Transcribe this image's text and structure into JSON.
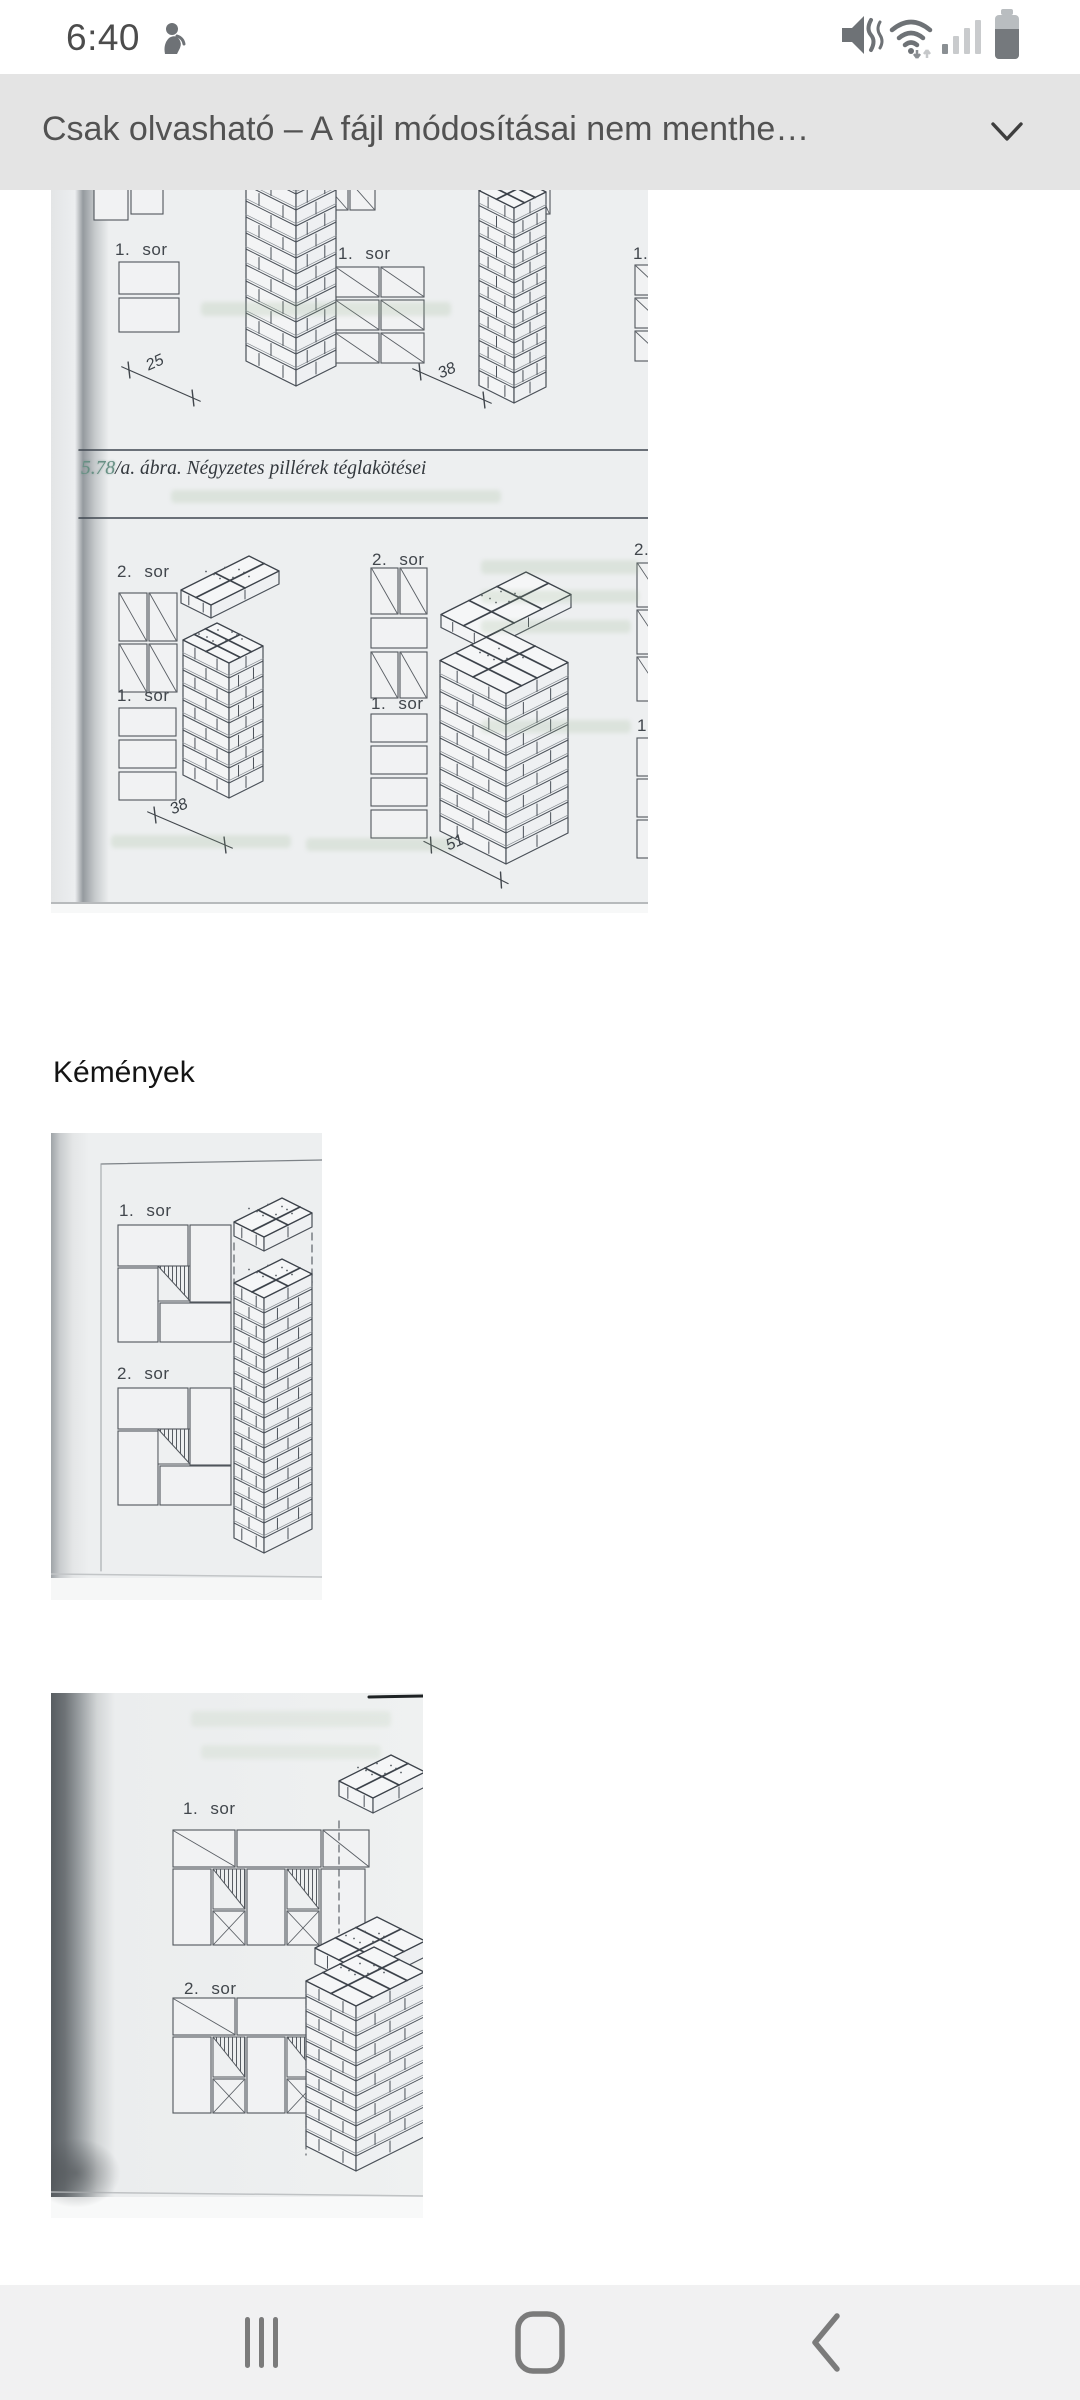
{
  "status_bar": {
    "time": "6:40"
  },
  "banner": {
    "message": "Csak olvasható – A fájl módosításai nem menthe…"
  },
  "document": {
    "heading": "Kémények",
    "figure1": {
      "caption_number": "5.78",
      "caption_text": "/a. ábra. Négyzetes pillérek téglakötései",
      "panel1_labels": [
        "1. sor",
        "1. sor",
        "1. sor"
      ],
      "panel1_dimensions": [
        "25",
        "38"
      ],
      "panel2_row_labels": [
        "2. sor",
        "2. sor",
        "2. sor"
      ],
      "panel2_base_labels": [
        "1. sor",
        "1. sor",
        "1. sor"
      ],
      "panel2_dimensions": [
        "38",
        "51"
      ]
    },
    "figure2": {
      "labels": [
        "1. sor",
        "2. sor"
      ]
    },
    "figure3": {
      "labels": [
        "1. sor",
        "2. sor"
      ]
    }
  }
}
